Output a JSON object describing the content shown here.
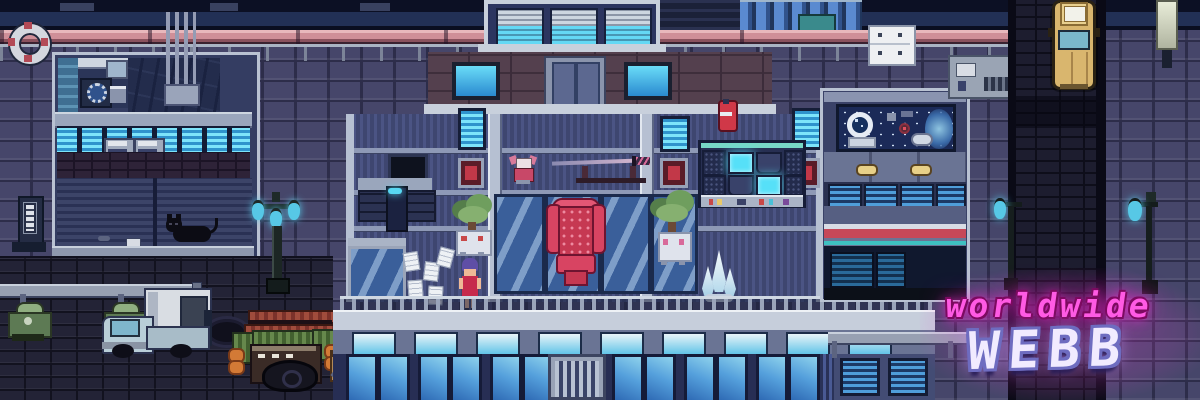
{
  "logo": {
    "line1": "worldwide",
    "line2": "WEBB"
  },
  "palette": {
    "neon_pink": "#ff4ae0",
    "bubble_letter": "#f1ebff",
    "window_cyan": "#7de4fa",
    "window_blue": "#4f9eda",
    "chair_red": "#d84462",
    "taxi_yellow": "#d9b66e",
    "brick_wall": "#46466a",
    "street_brick": "#232336",
    "lamp_teal": "#57c8e6"
  }
}
